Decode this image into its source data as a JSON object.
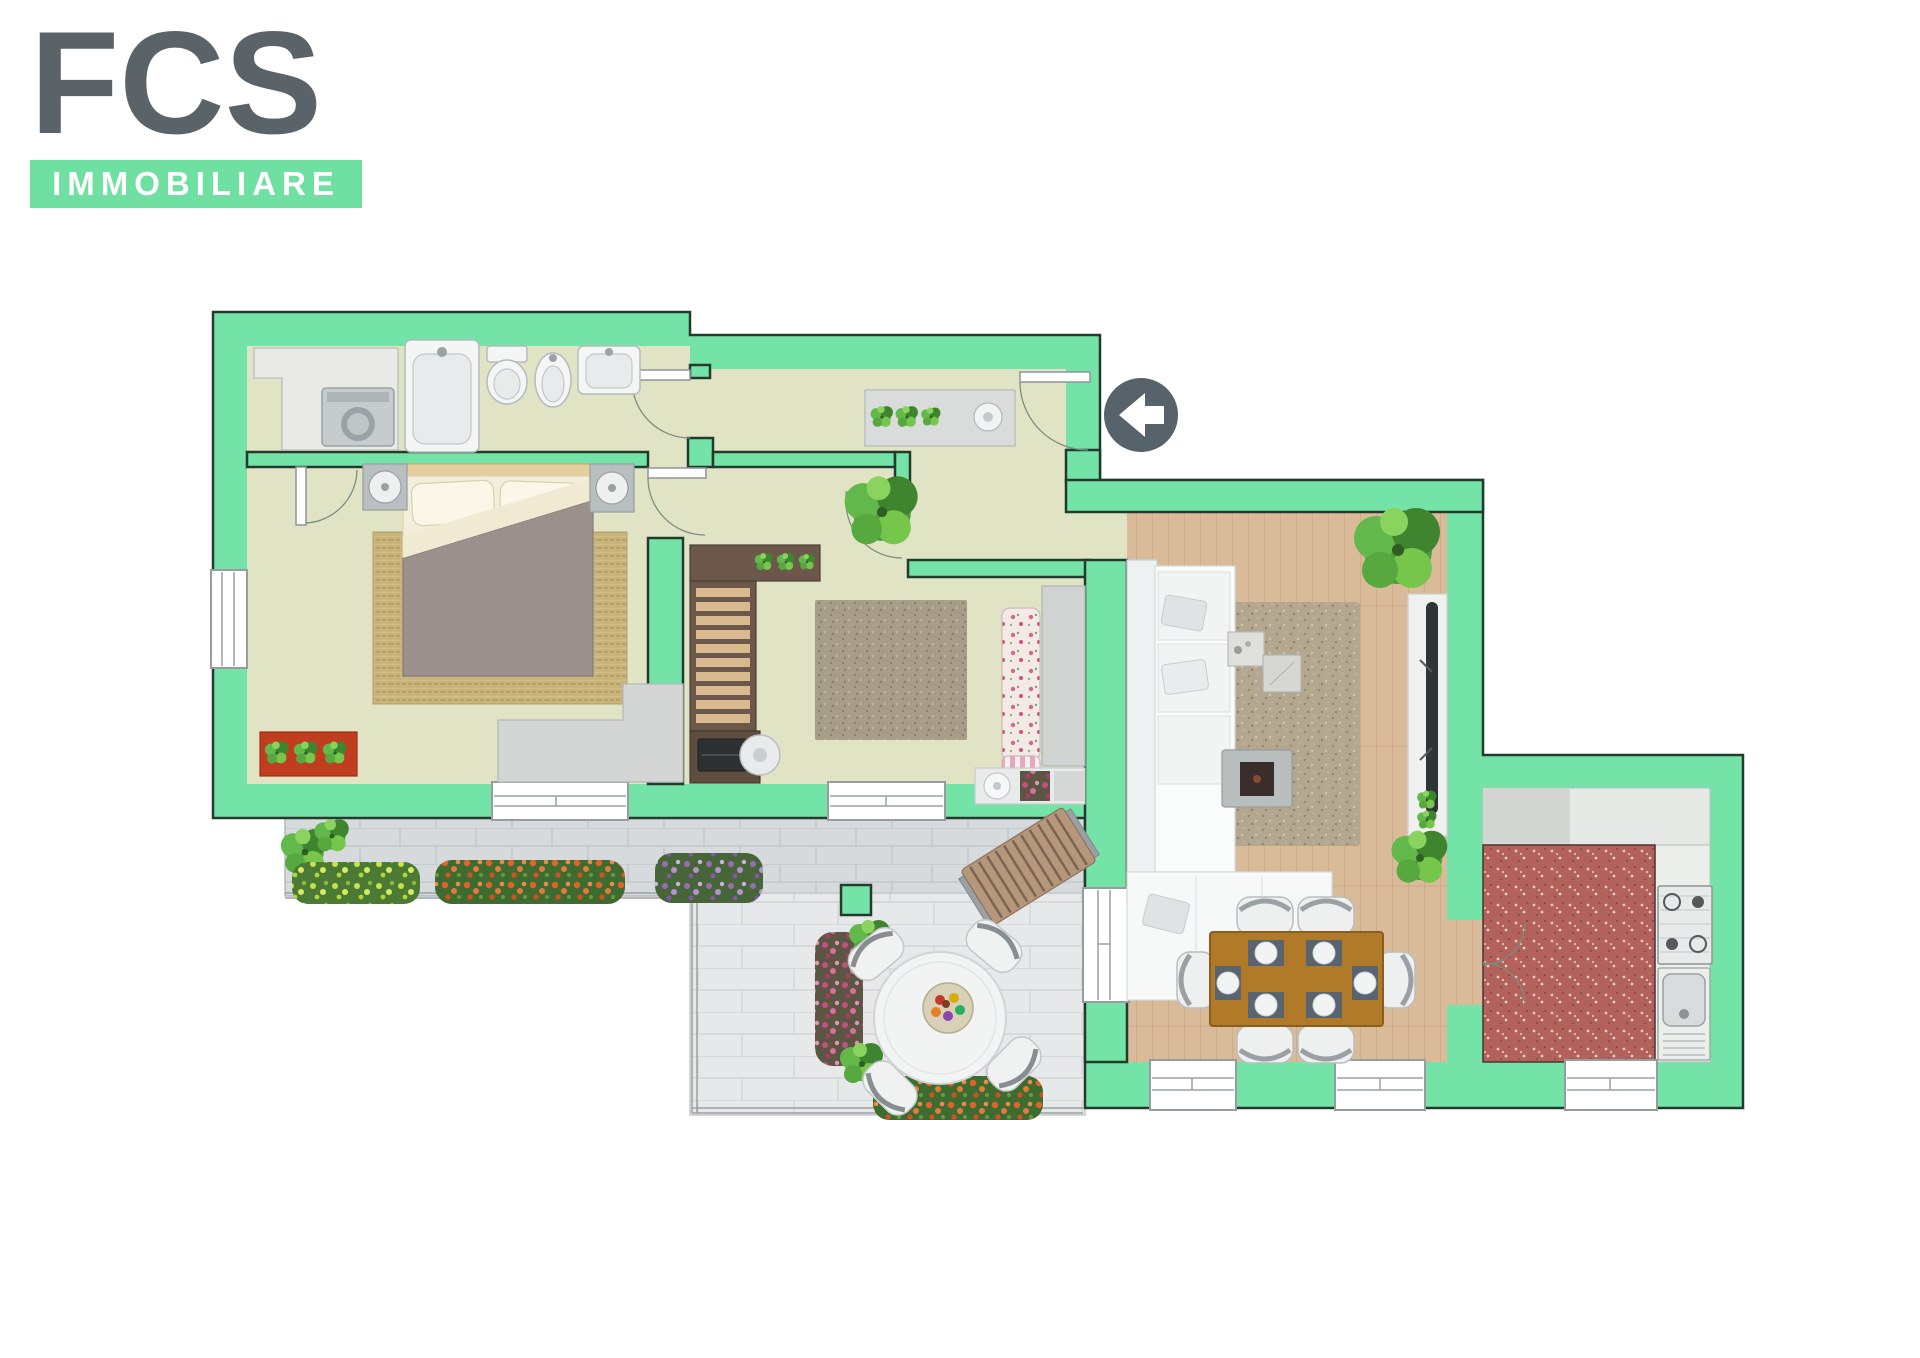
{
  "brand": {
    "acronym": "FCS",
    "subtitle": "IMMOBILIARE"
  },
  "palette": {
    "logo_gray": "#5a6468",
    "brand_green": "#6fe0a2",
    "wall_green": "#74e3a7",
    "wall_outline": "#243a2d",
    "floor_sage": "#e0e4c4",
    "floor_wood": "#d9ba99",
    "floor_kitchen": "#b2625a",
    "counter_gray": "#e6e8e6",
    "terrace_tile": "#d6dadc",
    "patio_tile": "#e6e8e9",
    "marker_gray": "#57636a",
    "accent_red_mat": "#c03d20",
    "dining_table_brown": "#b07a28",
    "bookshelf_brown": "#6b584a"
  },
  "floorplan": {
    "description": "apartment-floor-plan-top-view",
    "rooms": [
      {
        "name": "bathroom-laundry"
      },
      {
        "name": "hallway"
      },
      {
        "name": "bedroom"
      },
      {
        "name": "study-bedroom-2"
      },
      {
        "name": "entry-vestibule"
      },
      {
        "name": "living-room"
      },
      {
        "name": "dining-area"
      },
      {
        "name": "kitchen"
      },
      {
        "name": "terrace"
      },
      {
        "name": "patio"
      }
    ],
    "furniture": [
      "washing-machine",
      "bathtub",
      "toilet",
      "bidet",
      "washbasin",
      "hall-console",
      "potted-plants",
      "double-bed",
      "nightstands",
      "bedside-lamps",
      "bedroom-rug",
      "red-mat",
      "wardrobe",
      "bookshelf",
      "desk",
      "laptop",
      "desk-chair",
      "study-rug",
      "floral-armchair",
      "corner-sofa",
      "shag-rug",
      "marble-coffee-cubes",
      "tv-stand",
      "television",
      "dining-table",
      "dining-chairs",
      "place-settings",
      "kitchen-counter",
      "gas-hob",
      "kitchen-sink",
      "sun-lounger",
      "garden-round-table",
      "fruit-bowl",
      "garden-chairs",
      "flower-bed-yellow",
      "flower-bed-orange",
      "flower-bed-purple",
      "flower-bed-pink",
      "bushes"
    ],
    "entrance_marker": {
      "icon": "arrow-left-icon"
    }
  }
}
